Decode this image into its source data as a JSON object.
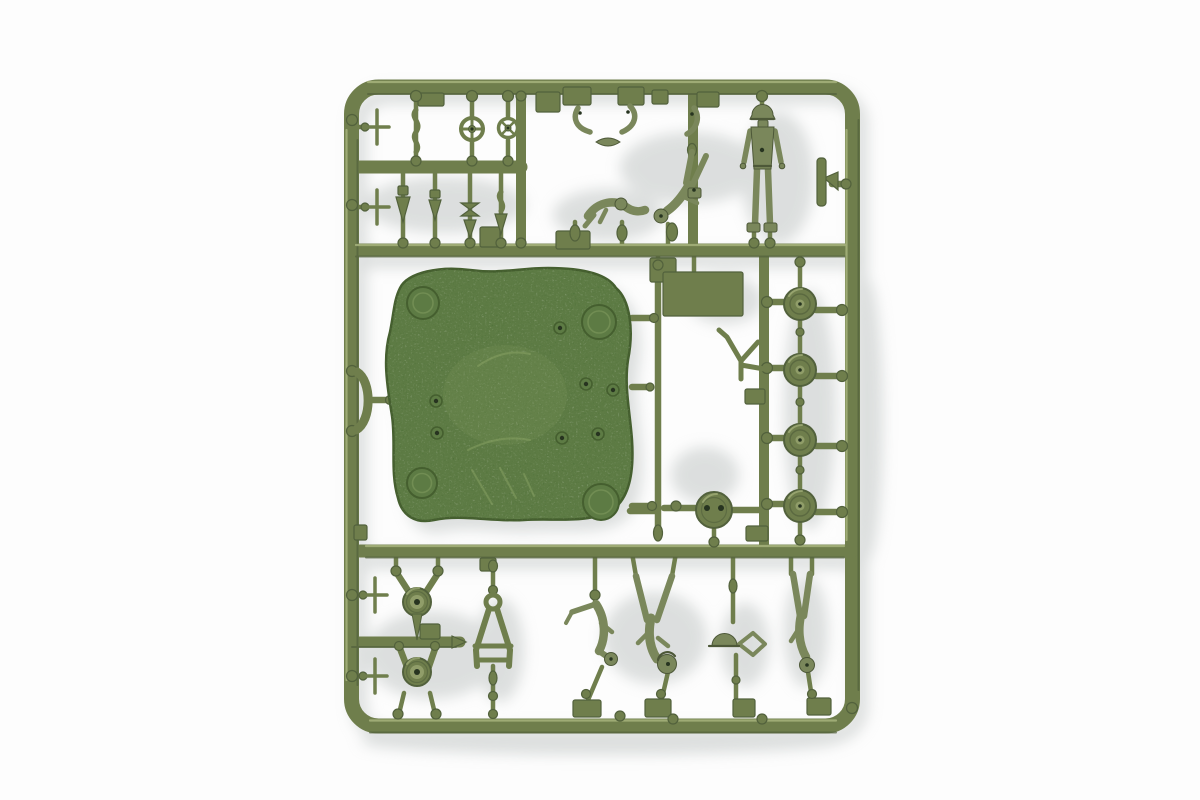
{
  "scene": {
    "type": "product photograph",
    "subject": "Olive-green injection-molded plastic model kit sprue (parts frame) with military figures and vehicle parts, photographed on a white background with soft shadows",
    "background_color": "#fdfdfd"
  },
  "colors": {
    "background": "#fdfdfd",
    "shadow": "#bcc1c0",
    "sprue": "#6f7e4c",
    "sprue_dark": "#52613c",
    "sprue_light": "#a7b37d",
    "plate": "#5d7b44",
    "plate_dark": "#455f2f",
    "plate_light": "#86a062",
    "figure": "#7a875b",
    "figure_dark": "#4d5838",
    "hole": "#273420"
  },
  "parts": {
    "frame": "rectangular sprue frame with rounded corners",
    "runners": "horizontal and vertical runner bars",
    "base_plate": "large pebble-textured base plate with four corner bosses and seven rivet holes",
    "road_wheels": {
      "label": "road wheels on right-hand runner",
      "count": 4
    },
    "spoked_wheels": {
      "label": "small spoked hand-wheels",
      "count": 2
    },
    "domed_wheels": {
      "label": "domed idler wheels",
      "count": 2
    },
    "disk_part": "round hatch disk with two holes",
    "flag_panel": "flat rectangular panel on long rod",
    "y_part": "Y-shaped linkage",
    "a_frame": "A-frame tow bar",
    "arc_part": "curved fender arc on left rail",
    "cross_parts": {
      "label": "cross-shaped aerial fittings",
      "count": 4
    },
    "cone_parts": {
      "label": "small cone and pulley fittings",
      "count": 4
    },
    "arm_parts": {
      "label": "bent crank-arm pieces",
      "count": 3
    },
    "winged_part": "small winged fitting",
    "standing_figure": "standing soldier figure",
    "crawling_figure": "crawling soldier figure",
    "bent_figure": "soldier figure bent head-down",
    "inverted_figure_center": "inverted soldier figure with spread legs",
    "helmet_figure": "helmeted figure with kit",
    "inverted_figure_right": "inverted soldier figure at right",
    "climbing_figure": "soldier figure with extended arm",
    "blade_part": "slim blade fitting on right rail",
    "twisted_parts": "small twisted strip fittings",
    "tabs": "flat rectangular molding tabs",
    "gates": "round sprue-gate bosses"
  }
}
